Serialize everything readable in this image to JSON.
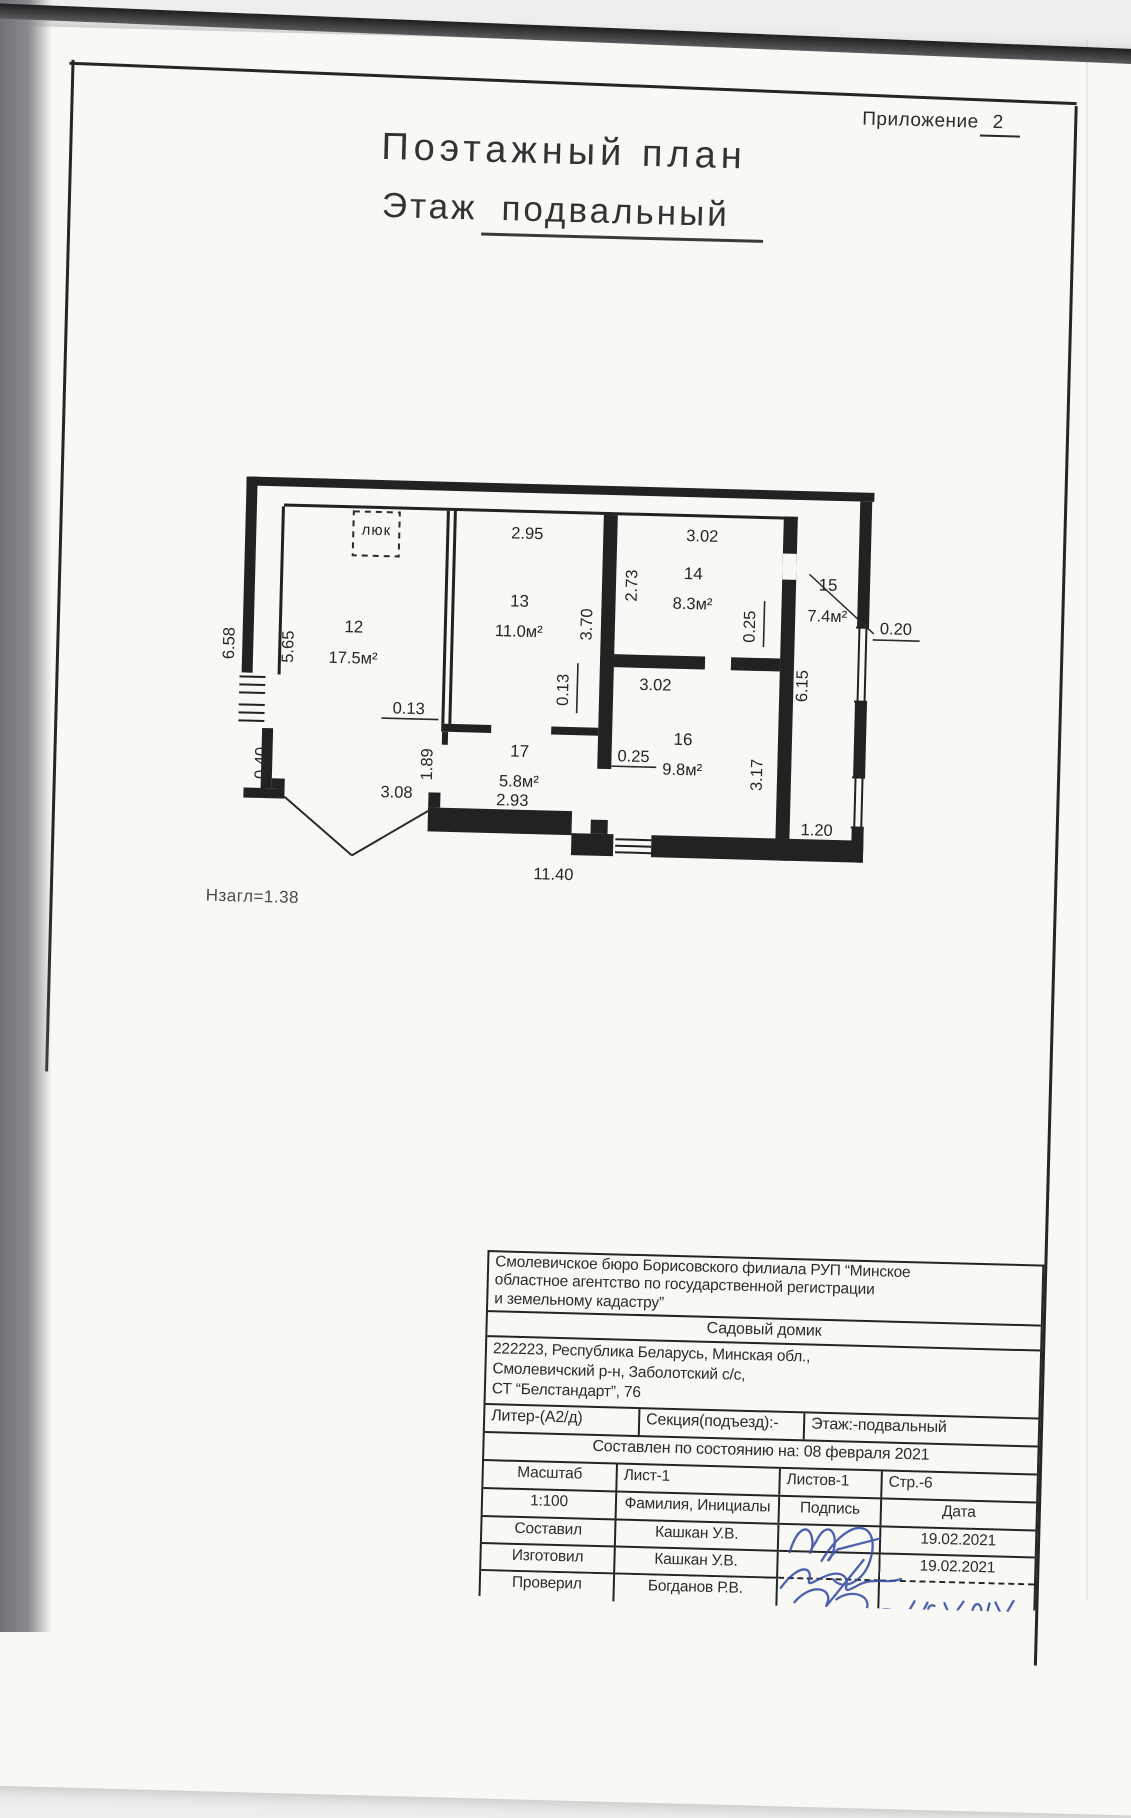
{
  "colors": {
    "ink": "#262626",
    "signature_blue": "#3c50a5",
    "paper": "#f8f8f5",
    "scanner_gray": "#707174"
  },
  "header": {
    "appendix_label": "Приложение",
    "appendix_number": "2",
    "title": "Поэтажный план",
    "floor_label": "Этаж",
    "floor_value": "подвальный"
  },
  "plan": {
    "hatch_label": "люк",
    "height_note": "Нзагл=1.38",
    "rooms": {
      "r12": {
        "no": "12",
        "area": "17.5м²"
      },
      "r13": {
        "no": "13",
        "area": "11.0м²"
      },
      "r14": {
        "no": "14",
        "area": "8.3м²"
      },
      "r15": {
        "no": "15",
        "area": "7.4м²"
      },
      "r16": {
        "no": "16",
        "area": "9.8м²"
      },
      "r17": {
        "no": "17",
        "area": "5.8м²"
      }
    },
    "dims": {
      "d658": "6.58",
      "d565": "5.65",
      "d040": "0.40",
      "d308": "3.08",
      "d1140": "11.40",
      "d293": "2.93",
      "d189": "1.89",
      "d013a": "0.13",
      "d013b": "0.13",
      "d295": "2.95",
      "d370": "3.70",
      "d273": "2.73",
      "d302a": "3.02",
      "d302b": "3.02",
      "d025a": "0.25",
      "d025b": "0.25",
      "d317": "3.17",
      "d615": "6.15",
      "d020": "0.20",
      "d120": "1.20"
    }
  },
  "title_block": {
    "org_lines": [
      "Смолевичское бюро Борисовского филиала РУП “Минское",
      "областное агентство по государственной регистрации",
      "и земельному кадастру”"
    ],
    "object_name": "Садовый домик",
    "address_lines": [
      "222223, Республика Беларусь, Минская обл.,",
      "Смолевичский р-н, Заболотский с/с,",
      "СТ “Белстандарт”, 76"
    ],
    "liter": "Литер-(А2/д)",
    "section": "Секция(подъезд):-",
    "floor": "Этаж:-подвальный",
    "status_line": "Составлен по состоянию на: 08 февраля 2021",
    "scale_label": "Масштаб",
    "scale_value": "1:100",
    "sheet": "Лист-1",
    "sheets": "Листов-1",
    "page": "Стр.-6",
    "name_header": "Фамилия, Инициалы",
    "signature_header": "Подпись",
    "date_header": "Дата",
    "signoff": [
      {
        "role": "Составил",
        "name": "Кашкан У.В.",
        "date": "19.02.2021"
      },
      {
        "role": "Изготовил",
        "name": "Кашкан У.В.",
        "date": "19.02.2021"
      },
      {
        "role": "Проверил",
        "name": "Богданов Р.В.",
        "date": ""
      }
    ]
  }
}
